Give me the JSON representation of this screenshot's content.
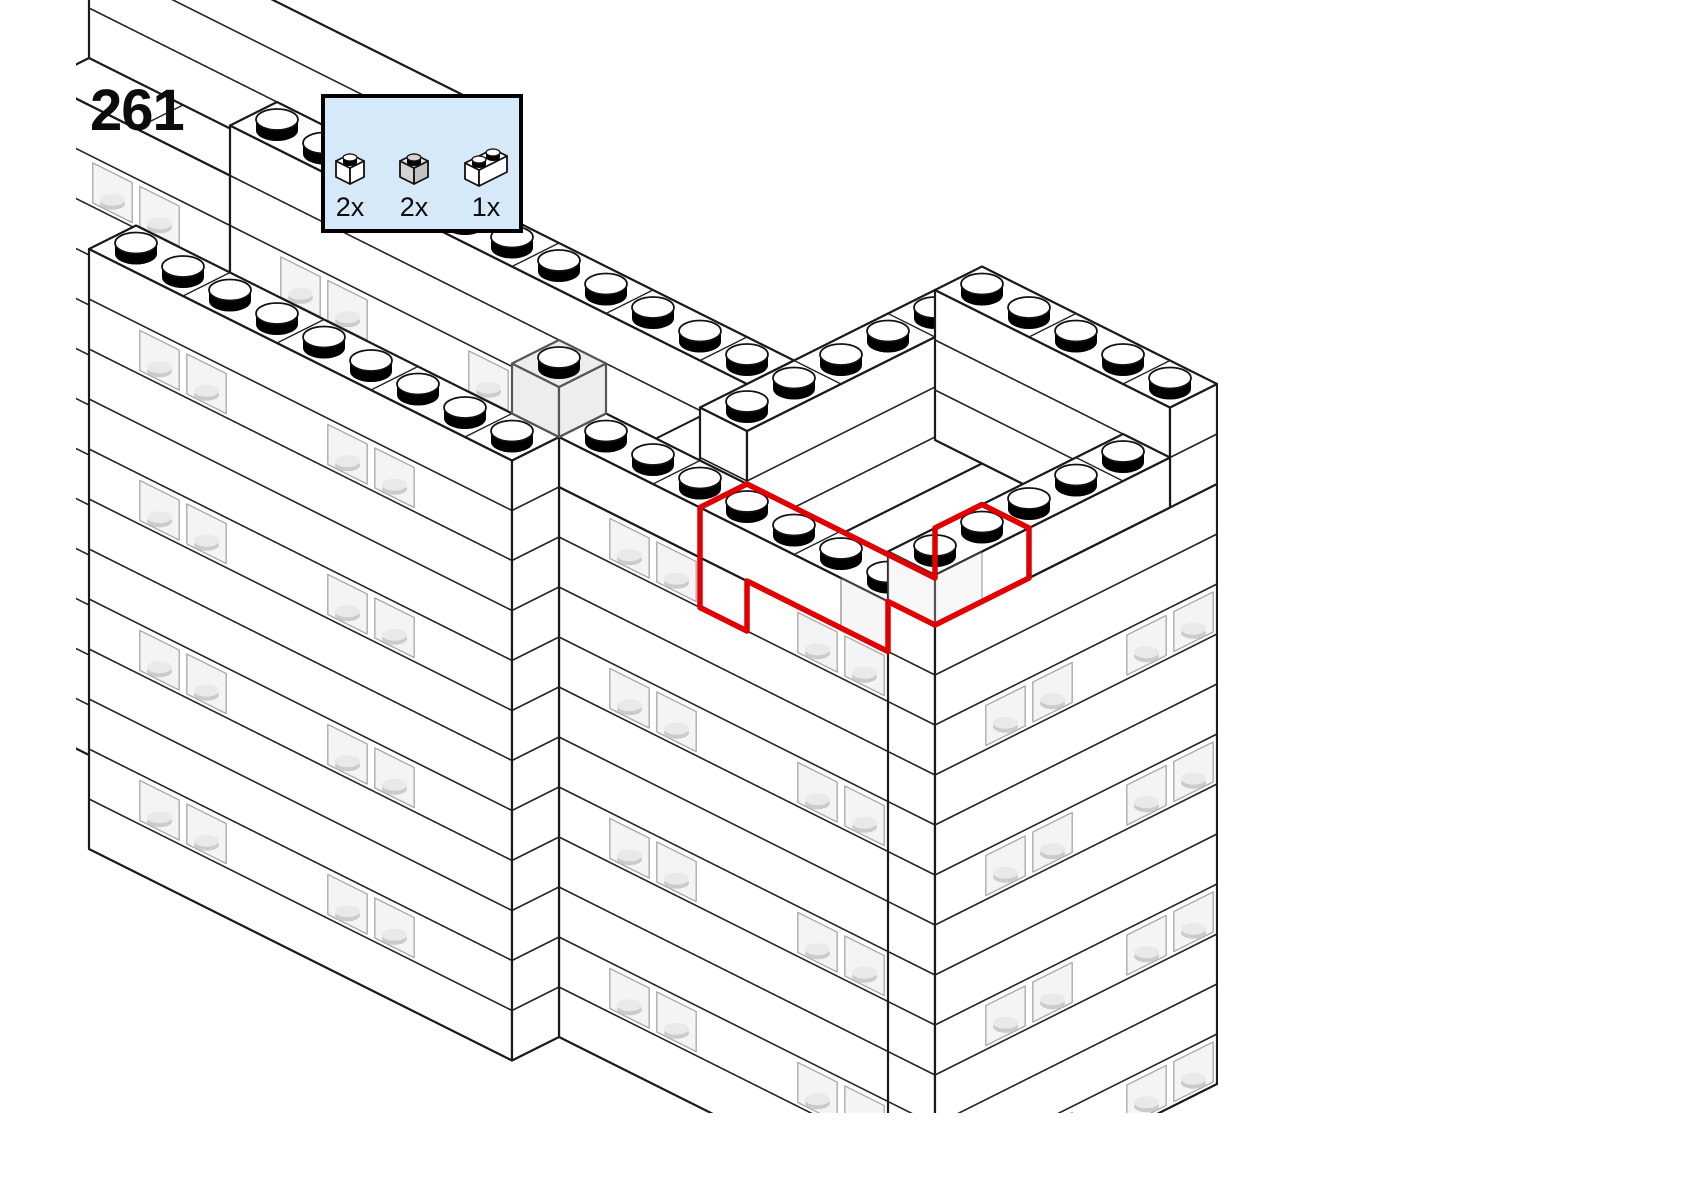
{
  "page": {
    "width": 1684,
    "height": 1192,
    "background": "#ffffff"
  },
  "step": {
    "number": "261"
  },
  "parts_callout": {
    "background": "#d6e9f8",
    "border_color": "#000000",
    "parts": [
      {
        "icon": "brick-1x1-white",
        "label": "2x"
      },
      {
        "icon": "brick-1x1-transparent",
        "label": "2x"
      },
      {
        "icon": "brick-1x2-white",
        "label": "1x"
      }
    ]
  },
  "highlight": {
    "color": "#e00000"
  },
  "drawing": {
    "line_color": "#1a1a1a",
    "brick_fill": "#ffffff",
    "stud_top": "#ffffff",
    "stud_side": "#000000",
    "window_tint": "#f1f1f1",
    "window_stroke": "#8a8a8a",
    "inner_stud": "#cbcbcb",
    "inner_stud_top": "#e9e9e9",
    "trans_face": "#ededed",
    "trans_stroke": "#555555"
  }
}
